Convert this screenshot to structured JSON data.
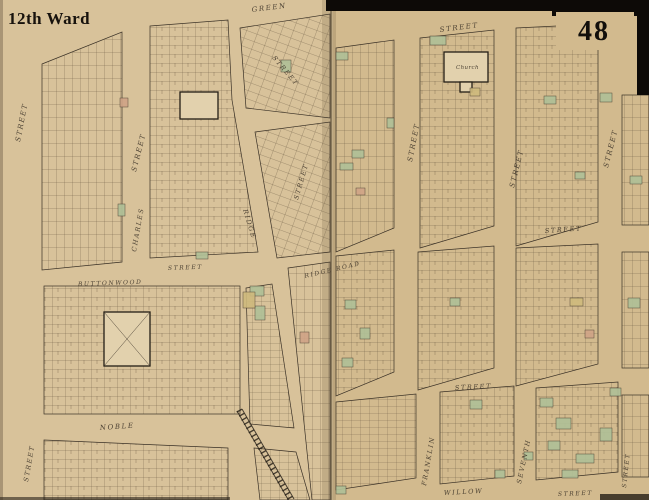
{
  "map": {
    "title": "12th Ward",
    "sheet_number": "48",
    "street_labels": [
      {
        "text": "GREEN"
      },
      {
        "text": "STREET"
      },
      {
        "text": "STREET"
      },
      {
        "text": "STREET"
      },
      {
        "text": "STREET"
      },
      {
        "text": "CHARLES"
      },
      {
        "text": "STREET"
      },
      {
        "text": "BUTTONWOOD"
      },
      {
        "text": "RIDGE"
      },
      {
        "text": "RIDGE ROAD"
      },
      {
        "text": "STREET"
      },
      {
        "text": "STREET"
      },
      {
        "text": "STREET"
      },
      {
        "text": "STREET"
      },
      {
        "text": "STREET"
      },
      {
        "text": "WILLOW"
      },
      {
        "text": "FRANKLIN"
      },
      {
        "text": "SEVENTH"
      },
      {
        "text": "STREET"
      },
      {
        "text": "STREET"
      },
      {
        "text": "NOBLE"
      },
      {
        "text": "STREET"
      },
      {
        "text": "STREET"
      }
    ],
    "landmarks": {
      "church": "Church"
    }
  },
  "colors": {
    "paper": "#d8c29a",
    "paper2": "#d2ba8e",
    "paper-light": "#e2d1ad",
    "ink": "#3a3126",
    "line": "#6e5d45",
    "green": "#b0c097",
    "salmon": "#d0a487",
    "yellow": "#cfba7d",
    "black": "#0d0a07"
  }
}
